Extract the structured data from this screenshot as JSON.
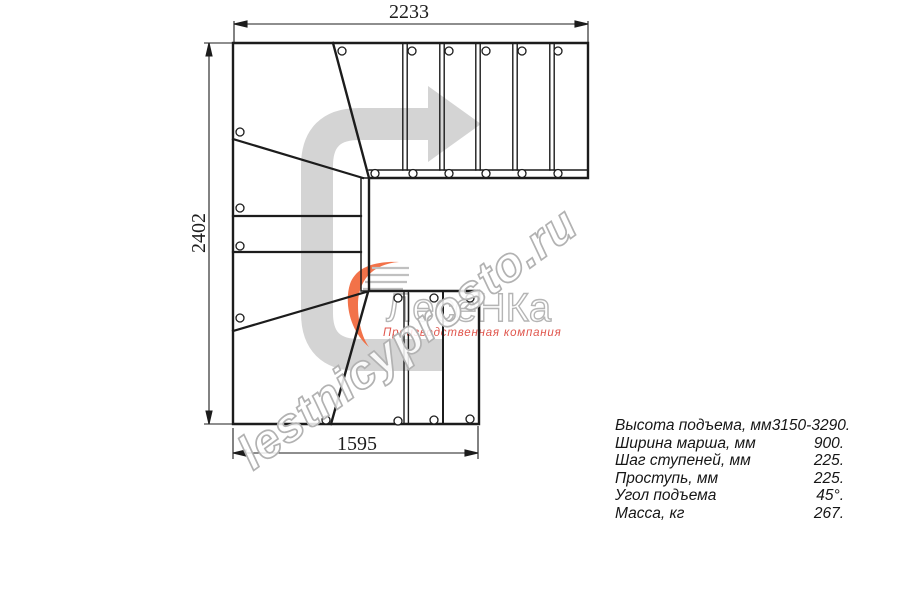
{
  "drawing": {
    "dimensions_mm": {
      "top": "2233",
      "left": "2402",
      "bottom": "1595"
    }
  },
  "specs": {
    "rows": [
      {
        "label": "Высота подъема, мм",
        "value": "3150-3290."
      },
      {
        "label": "Ширина марша, мм",
        "value": "900."
      },
      {
        "label": "Шаг ступеней, мм",
        "value": "225."
      },
      {
        "label": "Проступь, мм",
        "value": "225."
      },
      {
        "label": "Угол подъема",
        "value": "45°."
      },
      {
        "label": "Масса, кг",
        "value": "267."
      }
    ]
  },
  "logo": {
    "name": "ЛесеНКа",
    "tagline": "Производственная компания"
  },
  "watermark": {
    "text": "lestnicyprosto.ru"
  },
  "colors": {
    "line": "#1c1c1c",
    "arrow_gray": "#d4d4d4",
    "logo_orange": "#f1663a",
    "logo_gray": "#b5b5b5",
    "tagline_red": "#e0554c",
    "watermark_gray": "#b2b2b2"
  }
}
